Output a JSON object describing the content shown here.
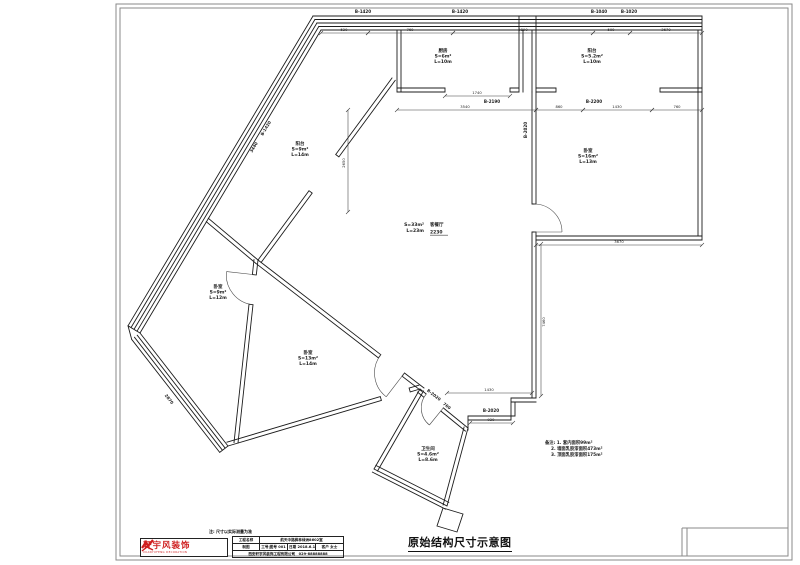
{
  "sheet": {
    "title": "原始结构尺寸示意图",
    "note": "注: 尺寸以实际测量为准",
    "logo": {
      "name": "轩宇风装饰",
      "sub": "XUANYUFENG DECORATION"
    },
    "title_block": {
      "row1_label": "工程名称",
      "row1_value": "航天中路枫林绿洲8602室",
      "row2_cells": [
        "制图",
        "工号|图号 001",
        "日期 2018.6.10",
        "客户 女士"
      ],
      "row3": "西安轩宇风装饰工程有限公司　029-88888888"
    }
  },
  "plan": {
    "rooms": [
      {
        "x": 443,
        "y": 52,
        "lines": [
          "厨房",
          "S=6m²",
          "L=10m"
        ]
      },
      {
        "x": 592,
        "y": 52,
        "lines": [
          "阳台",
          "S=5.2m²",
          "L=10m"
        ]
      },
      {
        "x": 588,
        "y": 152,
        "lines": [
          "卧室",
          "S=16m²",
          "L=13m"
        ]
      },
      {
        "x": 300,
        "y": 145,
        "lines": [
          "阳台",
          "S=9m²",
          "L=14m"
        ]
      },
      {
        "x": 218,
        "y": 288,
        "lines": [
          "卧室",
          "S=9m²",
          "L=12m"
        ]
      },
      {
        "x": 308,
        "y": 354,
        "lines": [
          "卧室",
          "S=13m²",
          "L=14m"
        ]
      },
      {
        "x": 428,
        "y": 450,
        "lines": [
          "卫生间",
          "S=4.6m²",
          "L=8.6m"
        ]
      }
    ],
    "living": {
      "name": "客餐厅",
      "area": "S=33m²",
      "length": "L=23m",
      "elev": "2230"
    },
    "labels": [
      {
        "t": "B-1420",
        "x": 363,
        "y": 13
      },
      {
        "t": "B-1420",
        "x": 460,
        "y": 13
      },
      {
        "t": "B-1040",
        "x": 599,
        "y": 13
      },
      {
        "t": "B-1020",
        "x": 629,
        "y": 13
      },
      {
        "t": "B-2190",
        "x": 492,
        "y": 103
      },
      {
        "t": "B-2200",
        "x": 594,
        "y": 103
      },
      {
        "t": "B-2020",
        "x": 527,
        "y": 130,
        "r": -90
      },
      {
        "t": "B-2020",
        "x": 491,
        "y": 412
      },
      {
        "t": "B-2020",
        "x": 433,
        "y": 396,
        "r": 38
      },
      {
        "t": "760",
        "x": 446,
        "y": 407,
        "r": 38
      },
      {
        "t": "B-1420",
        "x": 267,
        "y": 129,
        "r": -59
      },
      {
        "t": "3440",
        "x": 255,
        "y": 148,
        "r": -59
      },
      {
        "t": "2870",
        "x": 168,
        "y": 400,
        "r": 52
      }
    ],
    "dims": [
      {
        "x1": 321,
        "y1": 33,
        "x2": 368,
        "y2": 33,
        "t": "520",
        "tx": 344,
        "ty": 31
      },
      {
        "x1": 368,
        "y1": 33,
        "x2": 453,
        "y2": 33,
        "t": "760",
        "tx": 410,
        "ty": 31
      },
      {
        "x1": 453,
        "y1": 33,
        "x2": 593,
        "y2": 33,
        "t": "2890",
        "tx": 523,
        "ty": 31
      },
      {
        "x1": 593,
        "y1": 33,
        "x2": 630,
        "y2": 33,
        "t": "500",
        "tx": 611,
        "ty": 31
      },
      {
        "x1": 630,
        "y1": 33,
        "x2": 702,
        "y2": 33,
        "t": "3670",
        "tx": 666,
        "ty": 31
      },
      {
        "x1": 445,
        "y1": 96,
        "x2": 510,
        "y2": 96,
        "t": "1740",
        "tx": 477,
        "ty": 94
      },
      {
        "x1": 397,
        "y1": 110,
        "x2": 536,
        "y2": 110,
        "t": "3540",
        "tx": 465,
        "ty": 108
      },
      {
        "x1": 536,
        "y1": 110,
        "x2": 583,
        "y2": 110,
        "t": "860",
        "tx": 559,
        "ty": 108
      },
      {
        "x1": 583,
        "y1": 110,
        "x2": 652,
        "y2": 110,
        "t": "1430",
        "tx": 617,
        "ty": 108
      },
      {
        "x1": 652,
        "y1": 110,
        "x2": 702,
        "y2": 110,
        "t": "760",
        "tx": 677,
        "ty": 108
      },
      {
        "x1": 536,
        "y1": 245,
        "x2": 702,
        "y2": 245,
        "t": "3670",
        "tx": 619,
        "ty": 243
      },
      {
        "x1": 541,
        "y1": 244,
        "x2": 541,
        "y2": 396,
        "t": "7460",
        "tx": 545,
        "ty": 322,
        "r": -90
      },
      {
        "x1": 348,
        "y1": 110,
        "x2": 348,
        "y2": 212,
        "t": "2650",
        "tx": 345,
        "ty": 163,
        "r": -90
      },
      {
        "x1": 447,
        "y1": 393,
        "x2": 532,
        "y2": 393,
        "t": "1430",
        "tx": 489,
        "ty": 391
      },
      {
        "x1": 470,
        "y1": 423,
        "x2": 513,
        "y2": 423,
        "t": "920",
        "tx": 491,
        "ty": 421
      }
    ],
    "notes": [
      "备注: 1. 套内面积99m²",
      "2. 墙面乳胶漆面积473m²",
      "3. 顶面乳胶漆面积175m²"
    ]
  },
  "colors": {
    "line": "#1c1c1c",
    "logo_red": "#cf2020"
  }
}
